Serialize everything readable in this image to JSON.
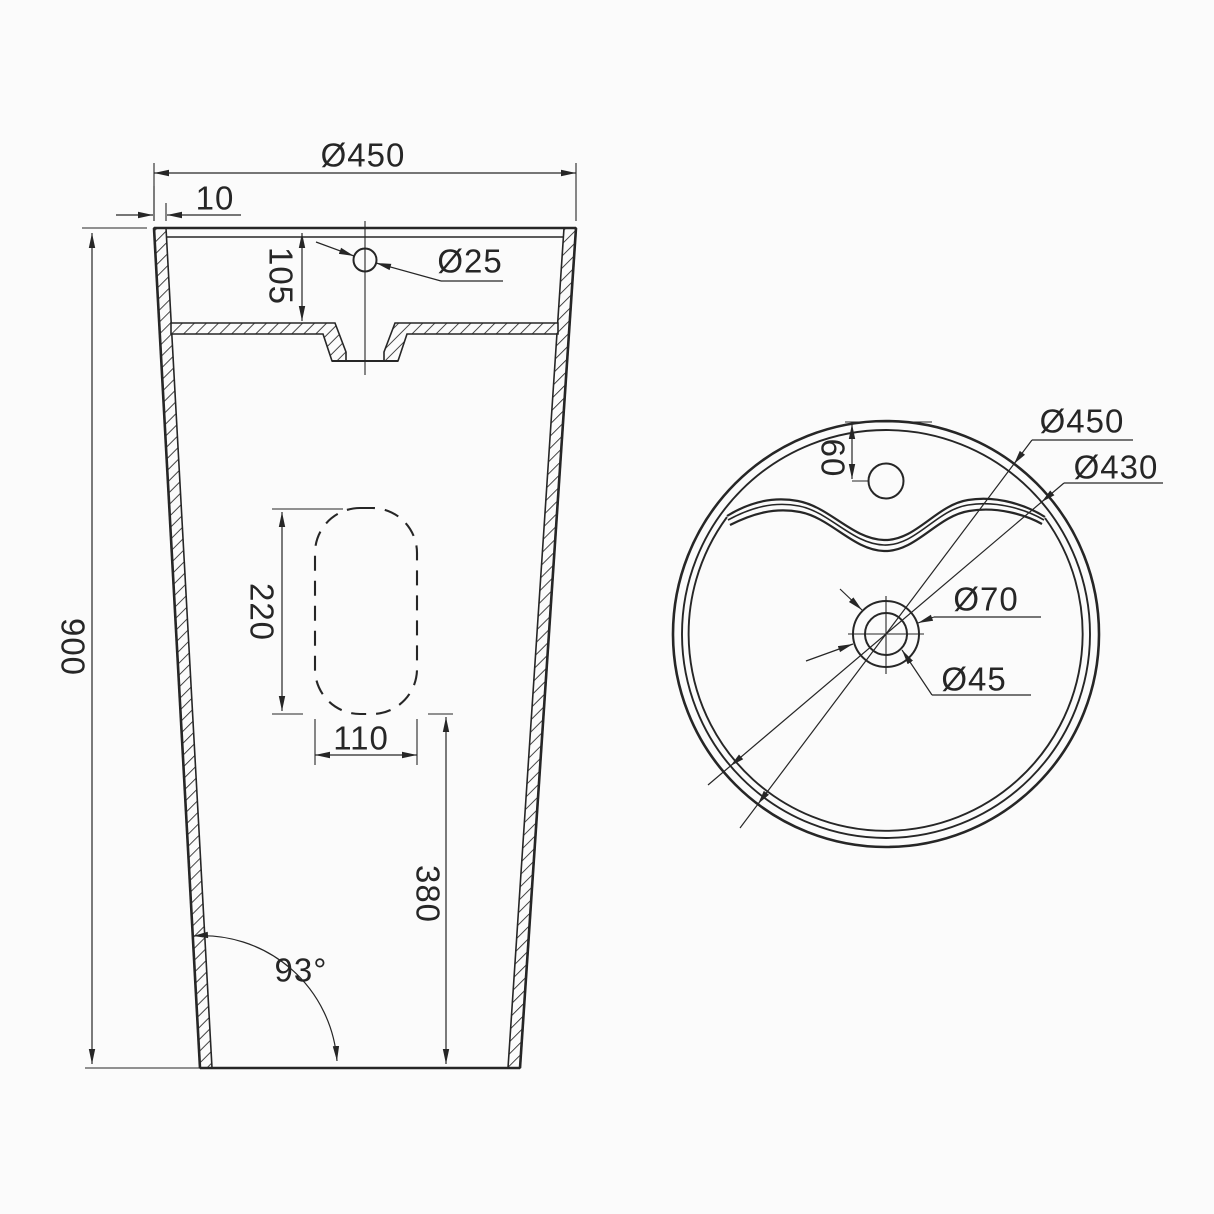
{
  "diagram": {
    "front_view": {
      "overall_width": "Ø450",
      "rim_thickness": "10",
      "basin_depth": "105",
      "faucet_hole": "Ø25",
      "overall_height": "900",
      "slot_height": "220",
      "slot_width": "110",
      "drain_height": "380",
      "base_angle": "93°"
    },
    "top_view": {
      "outer_diameter": "Ø450",
      "inner_diameter": "Ø430",
      "drain_outer": "Ø70",
      "drain_hole": "Ø45",
      "faucet_offset": "60"
    },
    "line_color": "#262626",
    "background": "#fbfbfb"
  }
}
